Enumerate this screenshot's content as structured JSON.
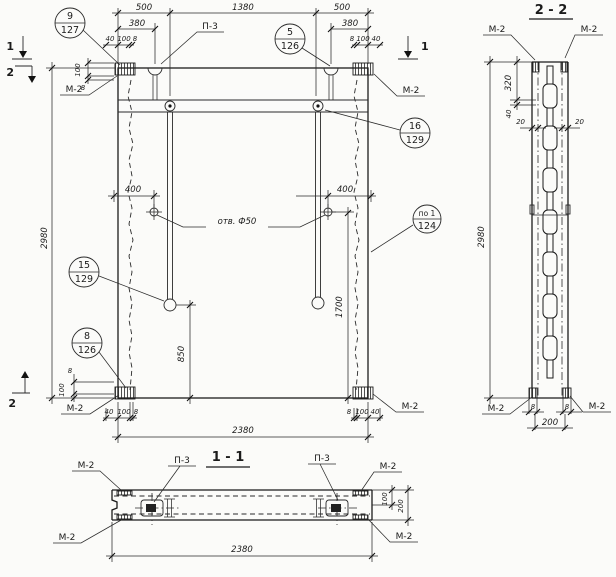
{
  "el": {
    "d500l": "500",
    "d1380": "1380",
    "d500r": "500",
    "d380l": "380",
    "d380r": "380",
    "d40": "40",
    "d100": "100",
    "d8": "8",
    "d2980": "2980",
    "d2380": "2380",
    "d400l": "400",
    "d400r": "400",
    "d850": "850",
    "d1700": "1700",
    "holes": "отв. Ф50"
  },
  "lbl": {
    "m2": "М-2",
    "p3": "П-3"
  },
  "marks": {
    "m1": "1",
    "m2": "2"
  },
  "callouts": {
    "c9": {
      "n": "9",
      "s": "127"
    },
    "c5": {
      "n": "5",
      "s": "126"
    },
    "c16": {
      "n": "16",
      "s": "129"
    },
    "cpo1": {
      "n": "по 1",
      "s": "124"
    },
    "c15": {
      "n": "15",
      "s": "129"
    },
    "c8": {
      "n": "8",
      "s": "126"
    }
  },
  "s22": {
    "title": "2 - 2",
    "d320": "320",
    "d40": "40",
    "d20": "20",
    "d2980": "2980",
    "d8": "8",
    "d200": "200"
  },
  "s11": {
    "title": "1 - 1",
    "d100": "100",
    "d200": "200",
    "d2380": "2380"
  }
}
